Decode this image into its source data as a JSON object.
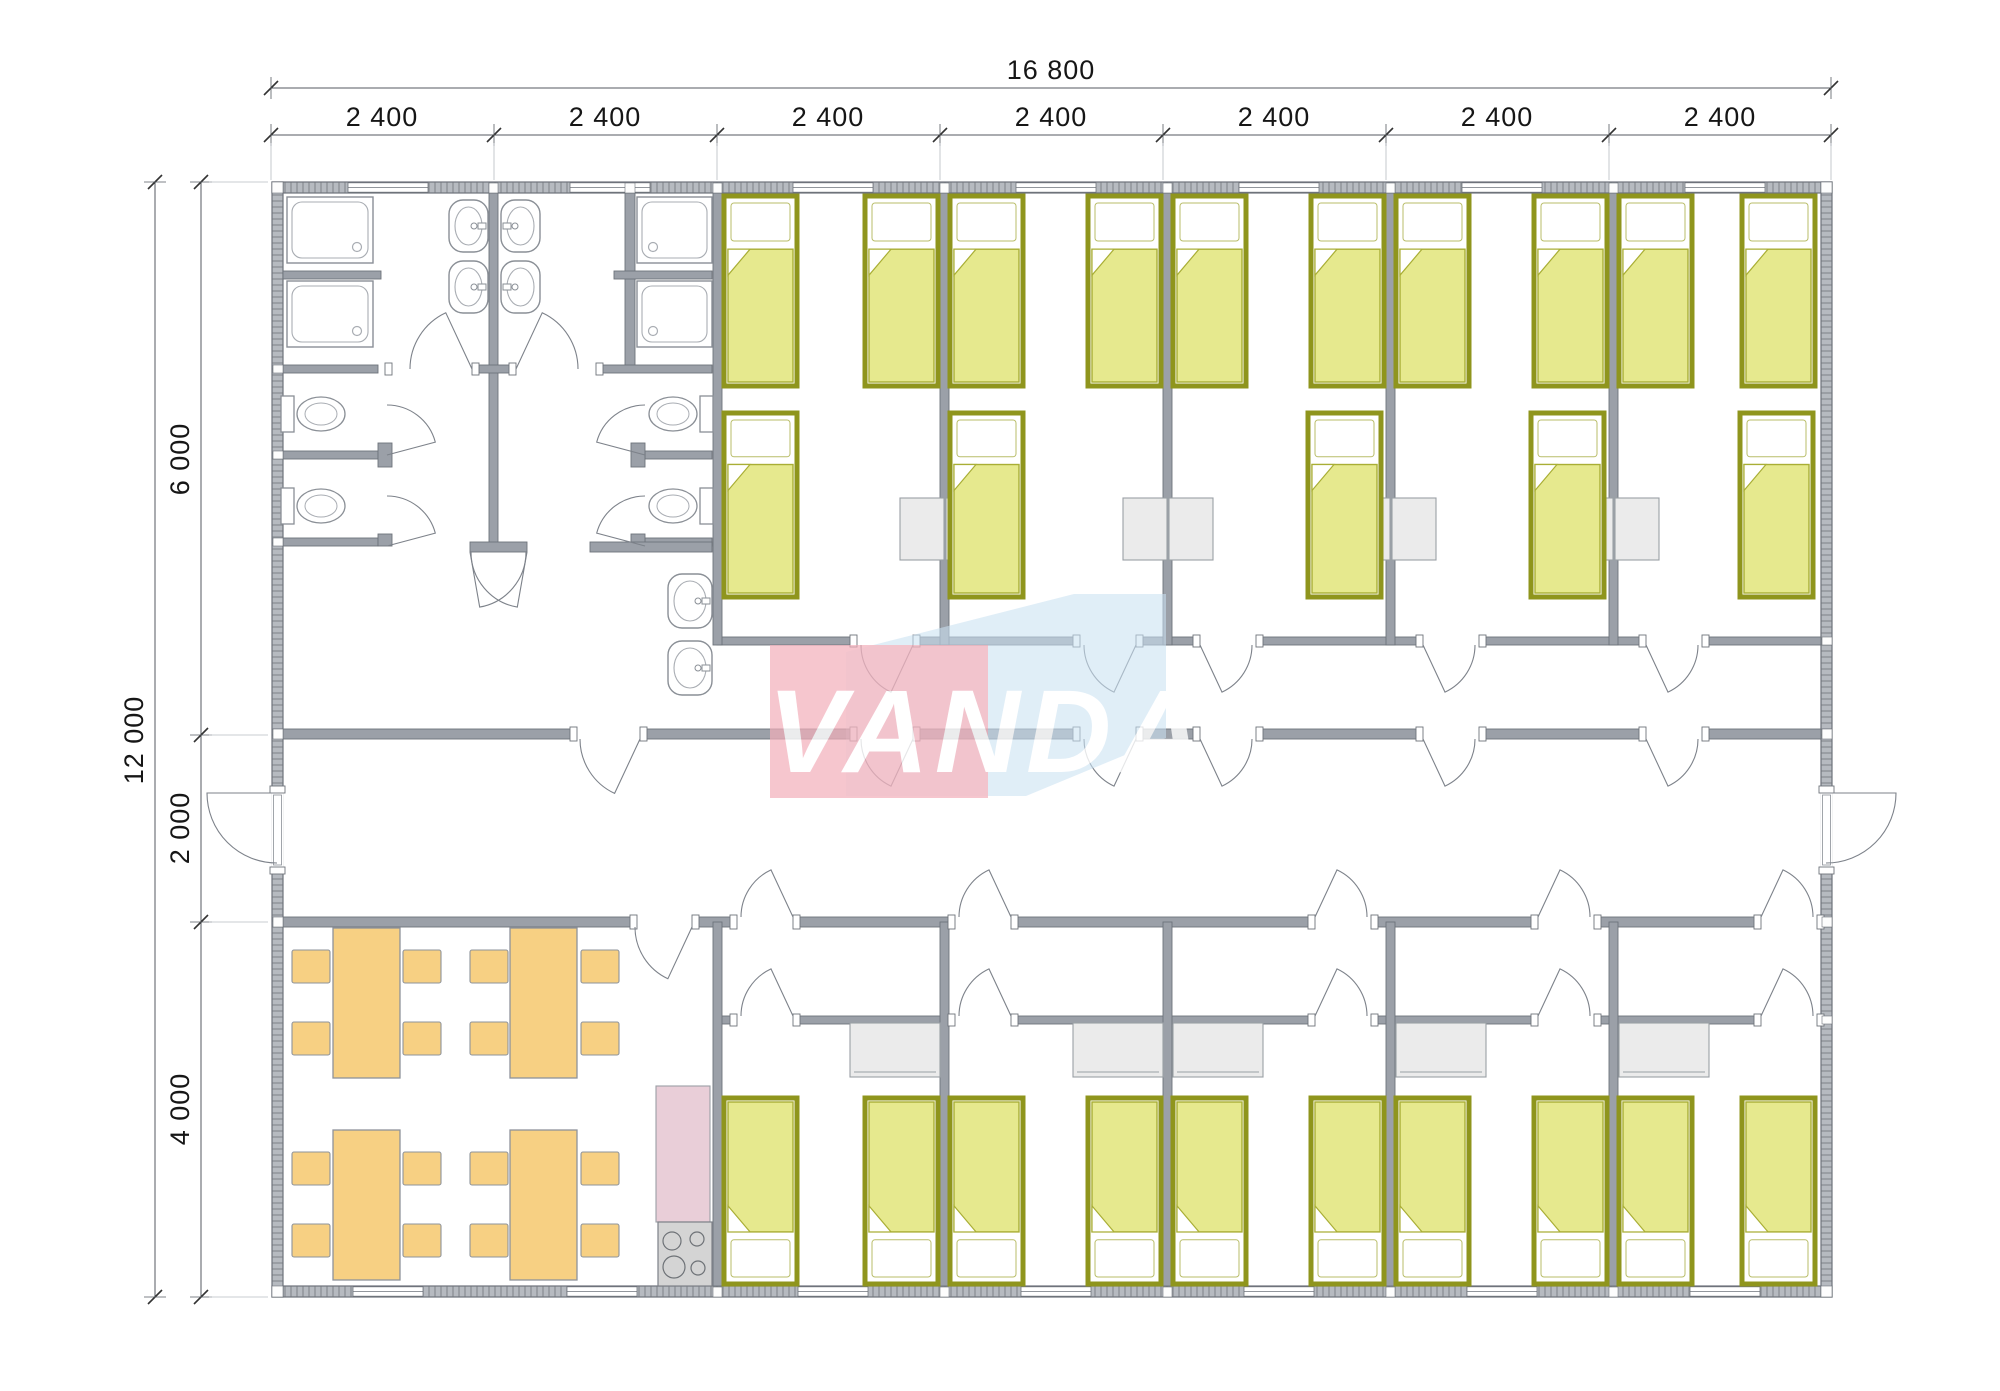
{
  "meta": {
    "type": "architectural-floor-plan",
    "units": "mm"
  },
  "watermark": {
    "text": "VANDA",
    "pink": "#f2aeba",
    "blue": "#c9e0f1",
    "text_color": "#ffffff",
    "pink_rect": [
      770,
      645,
      218,
      153
    ],
    "blue_poly": "846,652 1074,594 1166,594 1166,738 1026,796 846,796",
    "text_pos": [
      988,
      772
    ],
    "font_size": 118
  },
  "colors": {
    "wall_fill": "#9ba0a8",
    "wall_stroke": "#6e737b",
    "ext_base": "#b6bac0",
    "ext_tick": "#888c92",
    "bed_frame": "#8f951d",
    "bed_blanket": "#e6e98e",
    "bed_blanket_line": "#a9ae35",
    "furniture": "#ebebeb",
    "furniture_stroke": "#9aa0a5",
    "wood": "#f7d083",
    "wood_stroke": "#8e939b",
    "counter": "#e9ced8",
    "stove": "#d4d4d4",
    "fixture_stroke": "#8a8f96",
    "dim_text": "#161616",
    "dim_line": "#555a60",
    "ext_hair": "#b7bcc2"
  },
  "dimensions": {
    "top_overall": {
      "label": "16 800",
      "y": 88,
      "x1": 271,
      "x2": 1831,
      "lx": 1051,
      "ly": 79
    },
    "top_segments": {
      "y": 135,
      "ticks": [
        271,
        494,
        717,
        940,
        1163,
        1386,
        1609,
        1831
      ],
      "ly": 126,
      "labels": [
        {
          "t": "2 400",
          "x": 382
        },
        {
          "t": "2 400",
          "x": 605
        },
        {
          "t": "2 400",
          "x": 828
        },
        {
          "t": "2 400",
          "x": 1051
        },
        {
          "t": "2 400",
          "x": 1274
        },
        {
          "t": "2 400",
          "x": 1497
        },
        {
          "t": "2 400",
          "x": 1720
        }
      ]
    },
    "left_overall": {
      "label": "12 000",
      "x": 155,
      "y1": 182,
      "y2": 1297,
      "lx": 143,
      "ly": 740
    },
    "left_segments": {
      "x": 201,
      "ticks": [
        182,
        735,
        922,
        1297
      ],
      "lx": 189,
      "labels": [
        {
          "t": "6 000",
          "y": 459
        },
        {
          "t": "2 000",
          "y": 828
        },
        {
          "t": "4 000",
          "y": 1109
        }
      ]
    }
  },
  "plan": {
    "ext_walls": [
      [
        272,
        182,
        1560,
        11
      ],
      [
        272,
        1286,
        1560,
        11
      ],
      [
        272,
        182,
        11,
        1115
      ],
      [
        1821,
        182,
        11,
        1115
      ]
    ],
    "walls": [
      [
        283,
        729,
        1538,
        10
      ],
      [
        283,
        917,
        1538,
        10
      ],
      [
        717,
        637,
        1104,
        8
      ],
      [
        717,
        1016,
        1104,
        8
      ],
      [
        940,
        193,
        9,
        452
      ],
      [
        1163,
        193,
        9,
        452
      ],
      [
        1386,
        193,
        9,
        452
      ],
      [
        1609,
        193,
        9,
        452
      ],
      [
        940,
        922,
        9,
        364
      ],
      [
        1163,
        922,
        9,
        364
      ],
      [
        1386,
        922,
        9,
        364
      ],
      [
        1609,
        922,
        9,
        364
      ],
      [
        713,
        193,
        9,
        452
      ],
      [
        713,
        922,
        9,
        364
      ],
      [
        489,
        193,
        9,
        350
      ],
      [
        625,
        193,
        10,
        176
      ],
      [
        283,
        365,
        95,
        8
      ],
      [
        472,
        365,
        44,
        8
      ],
      [
        596,
        365,
        116,
        8
      ],
      [
        283,
        451,
        95,
        8
      ],
      [
        645,
        451,
        67,
        8
      ],
      [
        283,
        538,
        95,
        8
      ],
      [
        645,
        538,
        67,
        8
      ],
      [
        378,
        443,
        14,
        24
      ],
      [
        631,
        443,
        14,
        24
      ],
      [
        378,
        534,
        14,
        12
      ],
      [
        631,
        534,
        14,
        12
      ],
      [
        470,
        542,
        57,
        10
      ],
      [
        590,
        542,
        122,
        10
      ],
      [
        283,
        271,
        98,
        8
      ],
      [
        614,
        271,
        98,
        8
      ]
    ],
    "joints": [
      [
        272,
        182,
        11,
        11
      ],
      [
        1821,
        182,
        11,
        11
      ],
      [
        272,
        1286,
        11,
        11
      ],
      [
        1821,
        1286,
        11,
        11
      ],
      [
        489,
        183,
        9,
        10
      ],
      [
        625,
        183,
        10,
        10
      ],
      [
        713,
        183,
        9,
        10
      ],
      [
        940,
        183,
        9,
        10
      ],
      [
        1163,
        183,
        9,
        10
      ],
      [
        1386,
        183,
        9,
        10
      ],
      [
        1609,
        183,
        9,
        10
      ],
      [
        713,
        1287,
        9,
        10
      ],
      [
        940,
        1287,
        9,
        10
      ],
      [
        1163,
        1287,
        9,
        10
      ],
      [
        1386,
        1287,
        9,
        10
      ],
      [
        1609,
        1287,
        9,
        10
      ],
      [
        273,
        365,
        10,
        8
      ],
      [
        273,
        451,
        10,
        8
      ],
      [
        273,
        538,
        10,
        8
      ],
      [
        273,
        729,
        10,
        10
      ],
      [
        273,
        917,
        10,
        10
      ],
      [
        1822,
        637,
        10,
        8
      ],
      [
        1822,
        729,
        10,
        10
      ],
      [
        1822,
        917,
        10,
        10
      ],
      [
        1822,
        1016,
        10,
        8
      ]
    ],
    "openings": [
      [
        577,
        729,
        63,
        10
      ],
      [
        857,
        729,
        56,
        10
      ],
      [
        1080,
        729,
        56,
        10
      ],
      [
        1200,
        729,
        56,
        10
      ],
      [
        1423,
        729,
        56,
        10
      ],
      [
        1646,
        729,
        56,
        10
      ],
      [
        637,
        917,
        55,
        10
      ],
      [
        737,
        917,
        56,
        10
      ],
      [
        955,
        917,
        56,
        10
      ],
      [
        1315,
        917,
        56,
        10
      ],
      [
        1538,
        917,
        56,
        10
      ],
      [
        1761,
        917,
        56,
        10
      ],
      [
        857,
        637,
        56,
        8
      ],
      [
        1080,
        637,
        56,
        8
      ],
      [
        1200,
        637,
        56,
        8
      ],
      [
        1423,
        637,
        56,
        8
      ],
      [
        1646,
        637,
        56,
        8
      ],
      [
        737,
        1016,
        56,
        8
      ],
      [
        955,
        1016,
        56,
        8
      ],
      [
        1315,
        1016,
        56,
        8
      ],
      [
        1538,
        1016,
        56,
        8
      ],
      [
        1761,
        1016,
        56,
        8
      ],
      [
        392,
        365,
        80,
        8
      ],
      [
        516,
        365,
        80,
        8
      ]
    ],
    "ext_door_openings": [
      [
        272,
        793,
        11,
        74
      ],
      [
        1821,
        793,
        11,
        74
      ]
    ],
    "windows": [
      [
        348,
        182,
        80,
        11
      ],
      [
        570,
        182,
        80,
        11
      ],
      [
        793,
        182,
        80,
        11
      ],
      [
        1016,
        182,
        80,
        11
      ],
      [
        1239,
        182,
        80,
        11
      ],
      [
        1462,
        182,
        80,
        11
      ],
      [
        1685,
        182,
        80,
        11
      ],
      [
        353,
        1286,
        70,
        11
      ],
      [
        567,
        1286,
        70,
        11
      ],
      [
        798,
        1286,
        70,
        11
      ],
      [
        1021,
        1286,
        70,
        11
      ],
      [
        1244,
        1286,
        70,
        11
      ],
      [
        1467,
        1286,
        70,
        11
      ],
      [
        1690,
        1286,
        70,
        11
      ]
    ],
    "doors": [
      [
        913,
        645,
        52,
        180,
        115
      ],
      [
        1136,
        645,
        52,
        180,
        115
      ],
      [
        1200,
        645,
        52,
        0,
        65
      ],
      [
        1423,
        645,
        52,
        0,
        65
      ],
      [
        1646,
        645,
        52,
        0,
        65
      ],
      [
        913,
        739,
        52,
        180,
        115
      ],
      [
        1136,
        739,
        52,
        180,
        115
      ],
      [
        1200,
        739,
        52,
        0,
        65
      ],
      [
        1423,
        739,
        52,
        0,
        65
      ],
      [
        1646,
        739,
        52,
        0,
        65
      ],
      [
        640,
        739,
        60,
        180,
        115
      ],
      [
        793,
        917,
        52,
        180,
        245
      ],
      [
        1011,
        917,
        52,
        180,
        245
      ],
      [
        1315,
        917,
        52,
        0,
        295
      ],
      [
        1538,
        917,
        52,
        0,
        295
      ],
      [
        1761,
        917,
        52,
        0,
        295
      ],
      [
        793,
        1016,
        52,
        180,
        245
      ],
      [
        1011,
        1016,
        52,
        180,
        245
      ],
      [
        1315,
        1016,
        52,
        0,
        295
      ],
      [
        1538,
        1016,
        52,
        0,
        295
      ],
      [
        1761,
        1016,
        52,
        0,
        295
      ],
      [
        692,
        927,
        57,
        180,
        115
      ],
      [
        277,
        793,
        70,
        90,
        180
      ],
      [
        1826,
        793,
        70,
        90,
        0
      ],
      [
        472,
        369,
        62,
        180,
        245
      ],
      [
        516,
        369,
        62,
        0,
        295
      ],
      [
        387,
        455,
        50,
        270,
        345
      ],
      [
        387,
        546,
        50,
        270,
        345
      ],
      [
        645,
        455,
        50,
        270,
        195
      ],
      [
        645,
        546,
        50,
        270,
        195
      ],
      [
        470,
        552,
        56,
        0,
        80
      ],
      [
        527,
        552,
        56,
        180,
        100
      ]
    ],
    "beds": [
      [
        724,
        196,
        73,
        190,
        "u"
      ],
      [
        865,
        196,
        73,
        190,
        "u"
      ],
      [
        950,
        196,
        73,
        190,
        "u"
      ],
      [
        1088,
        196,
        73,
        190,
        "u"
      ],
      [
        1173,
        196,
        73,
        190,
        "u"
      ],
      [
        1311,
        196,
        73,
        190,
        "u"
      ],
      [
        1396,
        196,
        73,
        190,
        "u"
      ],
      [
        1534,
        196,
        73,
        190,
        "u"
      ],
      [
        1619,
        196,
        73,
        190,
        "u"
      ],
      [
        1742,
        196,
        73,
        190,
        "u"
      ],
      [
        724,
        413,
        73,
        184,
        "u"
      ],
      [
        950,
        413,
        73,
        184,
        "u"
      ],
      [
        1308,
        413,
        73,
        184,
        "u"
      ],
      [
        1531,
        413,
        73,
        184,
        "u"
      ],
      [
        1740,
        413,
        73,
        184,
        "u"
      ],
      [
        724,
        1098,
        73,
        186,
        "d"
      ],
      [
        865,
        1098,
        73,
        186,
        "d"
      ],
      [
        950,
        1098,
        73,
        186,
        "d"
      ],
      [
        1088,
        1098,
        73,
        186,
        "d"
      ],
      [
        1173,
        1098,
        73,
        186,
        "d"
      ],
      [
        1311,
        1098,
        73,
        186,
        "d"
      ],
      [
        1396,
        1098,
        73,
        186,
        "d"
      ],
      [
        1534,
        1098,
        73,
        186,
        "d"
      ],
      [
        1619,
        1098,
        73,
        186,
        "d"
      ],
      [
        1742,
        1098,
        73,
        186,
        "d"
      ]
    ],
    "showers": [
      [
        287,
        197,
        86,
        66,
        "br"
      ],
      [
        287,
        281,
        86,
        66,
        "br"
      ],
      [
        637,
        197,
        75,
        66,
        "bl"
      ],
      [
        637,
        281,
        75,
        66,
        "bl"
      ]
    ],
    "toilets": [
      {
        "tank": [
          281,
          396
        ],
        "bowl": [
          321,
          414
        ]
      },
      {
        "tank": [
          281,
          488
        ],
        "bowl": [
          321,
          506
        ]
      },
      {
        "tank": [
          700,
          396
        ],
        "bowl": [
          673,
          414
        ]
      },
      {
        "tank": [
          700,
          488
        ],
        "bowl": [
          673,
          506
        ]
      }
    ],
    "sinks": [
      {
        "r": [
          449,
          200,
          39,
          52
        ],
        "tap": "r"
      },
      {
        "r": [
          449,
          261,
          39,
          52
        ],
        "tap": "r"
      },
      {
        "r": [
          501,
          200,
          39,
          52
        ],
        "tap": "l"
      },
      {
        "r": [
          501,
          261,
          39,
          52
        ],
        "tap": "l"
      },
      {
        "r": [
          668,
          574,
          44,
          54
        ],
        "tap": "r"
      },
      {
        "r": [
          668,
          641,
          44,
          54
        ],
        "tap": "r"
      }
    ],
    "nightstands": [
      [
        900,
        498,
        44,
        62
      ],
      [
        946,
        498,
        44,
        62
      ],
      [
        1123,
        498,
        44,
        62
      ],
      [
        1169,
        498,
        44,
        62
      ],
      [
        1346,
        498,
        44,
        62
      ],
      [
        1392,
        498,
        44,
        62
      ],
      [
        1569,
        498,
        44,
        62
      ],
      [
        1615,
        498,
        44,
        62
      ]
    ],
    "wardrobes": [
      [
        850,
        1023,
        90,
        54
      ],
      [
        1073,
        1023,
        90,
        54
      ],
      [
        1173,
        1023,
        90,
        54
      ],
      [
        1396,
        1023,
        90,
        54
      ],
      [
        1619,
        1023,
        90,
        54
      ]
    ],
    "tables": [
      [
        333,
        928,
        67,
        150
      ],
      [
        510,
        928,
        67,
        150
      ],
      [
        333,
        1130,
        67,
        150
      ],
      [
        510,
        1130,
        67,
        150
      ]
    ],
    "chair_size": [
      38,
      33
    ],
    "chairs": [
      [
        292,
        950
      ],
      [
        292,
        1022
      ],
      [
        403,
        950
      ],
      [
        403,
        1022
      ],
      [
        470,
        950
      ],
      [
        470,
        1022
      ],
      [
        581,
        950
      ],
      [
        581,
        1022
      ],
      [
        292,
        1152
      ],
      [
        292,
        1224
      ],
      [
        403,
        1152
      ],
      [
        403,
        1224
      ],
      [
        470,
        1152
      ],
      [
        470,
        1224
      ],
      [
        581,
        1152
      ],
      [
        581,
        1224
      ]
    ],
    "counter": [
      656,
      1086,
      54,
      136
    ],
    "stove": {
      "rect": [
        658,
        1222,
        54,
        64
      ],
      "burners": [
        [
          672,
          1241,
          9
        ],
        [
          697,
          1239,
          7
        ],
        [
          674,
          1267,
          11
        ],
        [
          698,
          1268,
          7
        ]
      ]
    }
  }
}
